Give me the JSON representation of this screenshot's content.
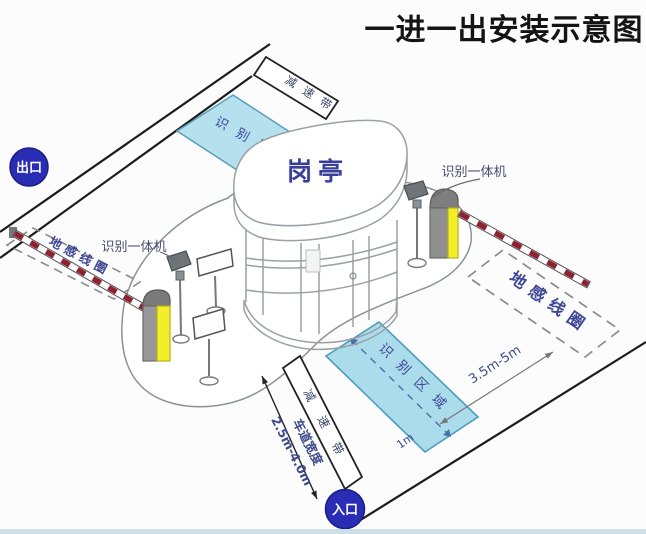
{
  "title": "一进一出安装示意图",
  "badges": {
    "exit": "出口",
    "entry": "入口"
  },
  "booth": {
    "label": "岗亭"
  },
  "equipment": {
    "camera_left": "识别一体机",
    "camera_right": "识别一体机"
  },
  "zones": {
    "coil_left": "地感线圈",
    "coil_right": "地感线圈",
    "area_top": "识别区域",
    "area_bottom": "识别区域",
    "bump_top": "减速带",
    "bump_bottom": "减速带"
  },
  "dimensions": {
    "coil_distance": "3.5m-5m",
    "area_offset": "1m",
    "lane_width_label": "车道宽度",
    "lane_width_value": "2.5m-4.0m"
  },
  "colors": {
    "badge_blue": "#2a2cb4",
    "area_blue": "#b5e0ee",
    "barrier_yellow": "#f2ee2a",
    "arm_red": "#8e2231",
    "label_navy": "#3d4796",
    "road_black": "#1c1c1c"
  }
}
